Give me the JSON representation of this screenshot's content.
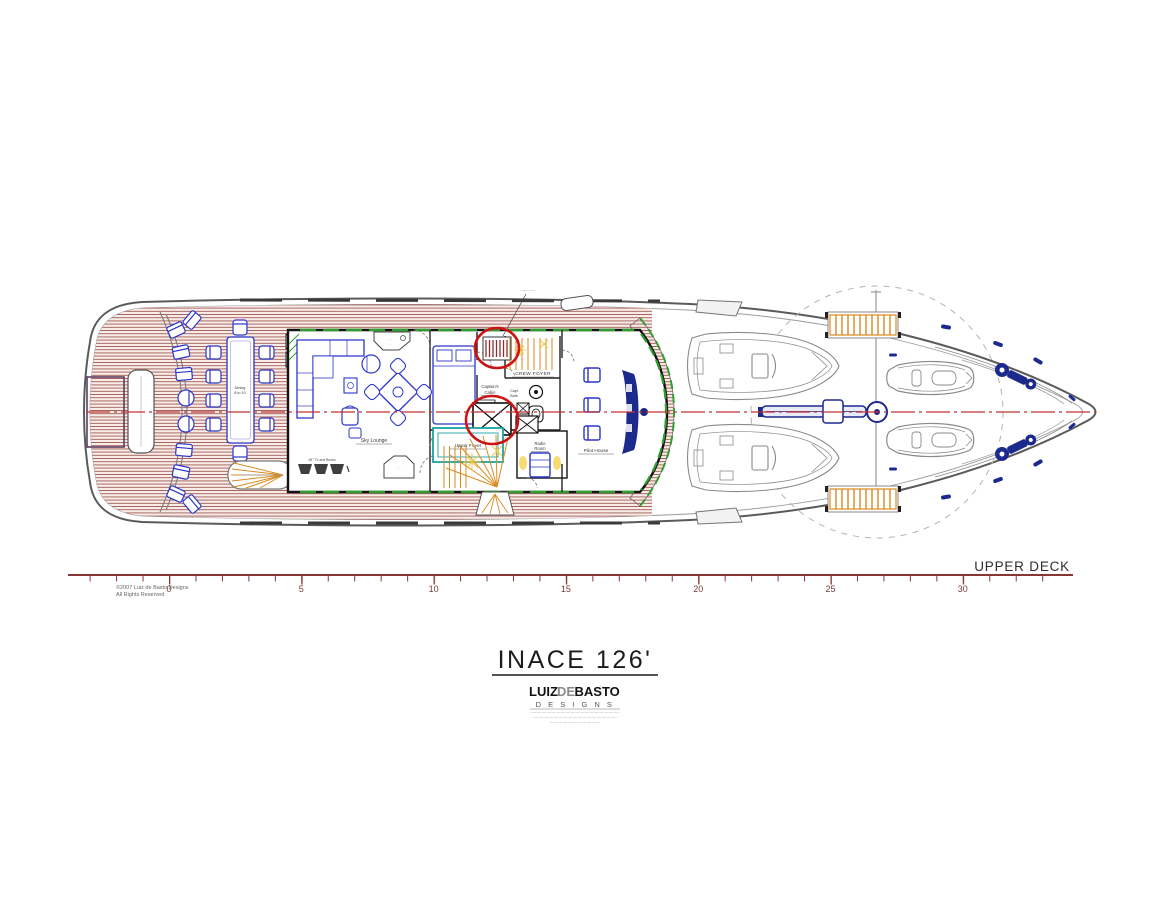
{
  "drawing": {
    "title": "INACE 126'",
    "deck_label": "UPPER DECK",
    "copyright_line1": "©2007 Luiz de Basto Designs",
    "copyright_line2": "All Rights Reserved"
  },
  "logo": {
    "part1": "LUIZ",
    "part2": "DE",
    "part3": "BASTO",
    "designs": "D E S I G N S",
    "fineprint_line1": "·······································································",
    "fineprint_line2": "··································································",
    "fineprint_line3": "········································"
  },
  "ruler": {
    "labels": [
      "0",
      "5",
      "10",
      "15",
      "20",
      "25",
      "30"
    ]
  },
  "rooms": {
    "sky_lounge": "Sky Lounge",
    "upper_foyer": "Upper Foyer",
    "radio_room_l1": "Radio",
    "radio_room_l2": "Room",
    "pilot_house": "Pilot House",
    "captains_cabin_l1": "Captain's",
    "captains_cabin_l2": "Cabin",
    "capt_bath_l1": "Capt",
    "capt_bath_l2": "Bath",
    "crew_foyer": "CREW FOYER",
    "dining_l1": "Dining",
    "dining_l2": "8 to 10",
    "tv_label": "48\" TV and Books",
    "bar_l1": "····",
    "bar_l2": "···",
    "corner_l1": "····",
    "callout": "·············"
  },
  "colors": {
    "planking": "#a25a55",
    "furniture_blue": "#2b35c8",
    "solid_navy": "#1b2a8c",
    "annotation_red": "#cc1414",
    "centerline_red": "#c23333",
    "stair_orange": "#d98a1f",
    "glass_green": "#2f9e2f",
    "foyer_teal": "#18a3a3",
    "ruler_maroon": "#8b3434"
  }
}
